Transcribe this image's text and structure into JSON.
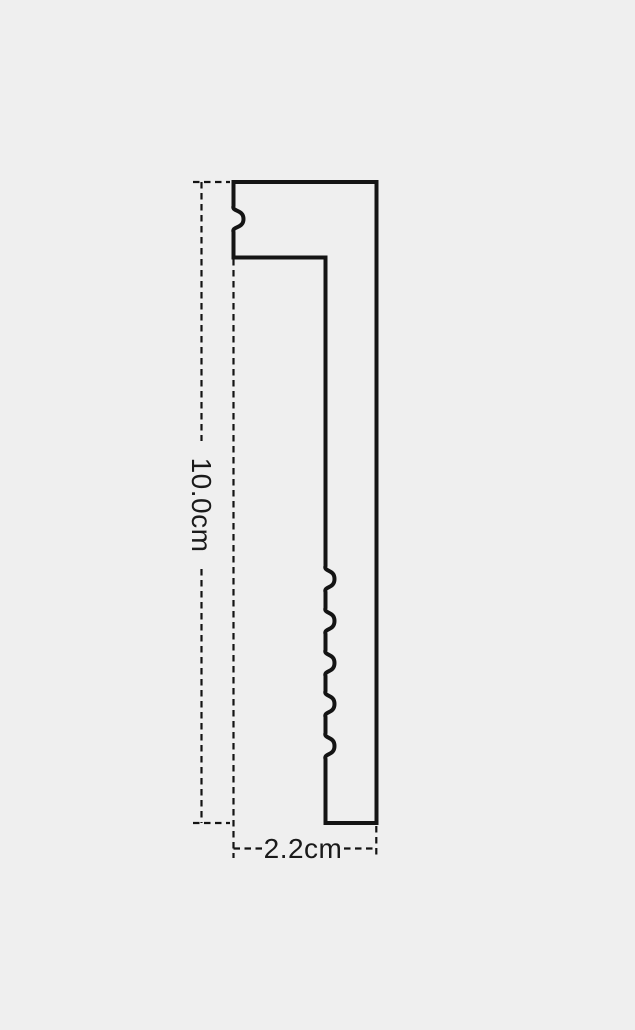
{
  "canvas": {
    "background_color": "#efefef",
    "line_color": "#141414"
  },
  "diagram": {
    "description": "Profile cross-section outline with dashed dimension lines",
    "height_dimension": {
      "label": "10.0cm"
    },
    "width_dimension": {
      "label": "2.2cm"
    }
  }
}
